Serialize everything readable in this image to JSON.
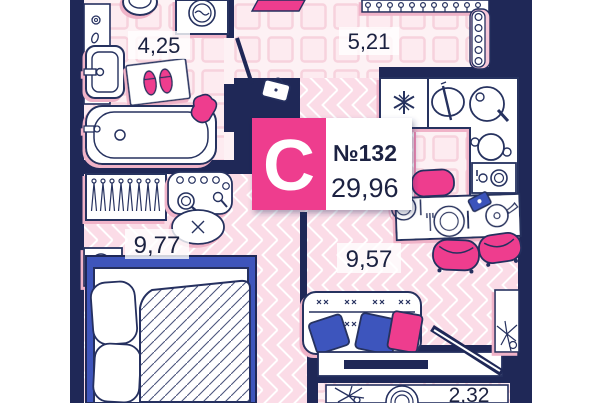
{
  "plan": {
    "unit_card": {
      "type_letter": "С",
      "number": "№132",
      "total_area": "29,96"
    },
    "rooms": {
      "bathroom": {
        "area": "4,25"
      },
      "hallway": {
        "area": "5,21"
      },
      "bedroom": {
        "area": "9,77"
      },
      "living_kitchen": {
        "area": "9,57"
      },
      "balcony": {
        "area": "2,32"
      }
    },
    "colors": {
      "wall_navy": "#1f2857",
      "outline_navy": "#25305f",
      "accent_pink": "#ee3d8e",
      "accent_pink_dark": "#d92a74",
      "floor_herringbone_pink": "#fbdce7",
      "floor_tile_pink": "#fdf1f4",
      "furniture_blue": "#3e55bb",
      "text_dark": "#1b2140",
      "white": "#ffffff"
    },
    "furniture_icons": [
      "toilet-icon",
      "washing-machine-icon",
      "bathroom-sink-icon",
      "bath-mat-slippers-icon",
      "bathtub-icon",
      "towel-icon",
      "entry-mat-icon",
      "closet-hangers-icon",
      "coat-rack-icon",
      "bathroom-door-icon",
      "bag-icon",
      "fridge-snowflake-icon",
      "cutting-board-icon",
      "cooktop-icon",
      "pot-icon",
      "oven-icon",
      "dining-table-icon",
      "chair-icon",
      "phone-icon",
      "teapot-icon",
      "wardrobe-hangers-icon",
      "vanity-icon",
      "pouf-icon",
      "nightstand-icon",
      "double-bed-icon",
      "sofa-icon",
      "pillow-icon",
      "tv-stand-icon",
      "balcony-door-icon",
      "plant-icon",
      "balcony-table-icon",
      "balcony-flower-icon"
    ]
  }
}
